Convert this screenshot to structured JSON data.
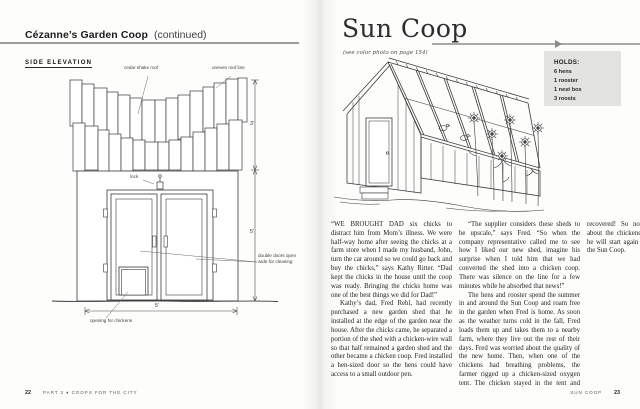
{
  "left_page": {
    "header": {
      "title": "Cézanne’s Garden Coop",
      "continued": "(continued)"
    },
    "section_label": "SIDE ELEVATION",
    "labels": {
      "cedar": "cedar shake roof",
      "uneven": "uneven roof line",
      "lock": "lock",
      "doors": "double doors open wide for cleaning",
      "opening": "opening for chickens",
      "dim_roof": "3'",
      "dim_wall": "5'",
      "dim_width": "5'"
    },
    "footer": {
      "page_number": "22",
      "text": "PART 2 ♦ COOPS FOR THE CITY"
    }
  },
  "right_page": {
    "title": "Sun Coop",
    "subtitle": "(see color photo on page 154)",
    "holds_box": {
      "heading": "HOLDS:",
      "items": [
        "6 hens",
        "1 rooster",
        "1 nest box",
        "3 roosts"
      ]
    },
    "body": {
      "paragraphs": [
        "“WE BROUGHT DAD six chicks to distract him from Mom’s illness. We were half-way home after seeing the chicks at a farm store when I made my husband, John, turn the car around so we could go back and buy the chicks,” says Kathy Ritter. “Dad kept the chicks in the house until the coop was ready. Bringing the chicks home was one of the best things we did for Dad!”",
        "Kathy’s dad, Fred Rehl, had recently purchased a new garden shed that he installed at the edge of the garden near the house. After the chicks came, he separated a portion of the shed with a chicken-wire wall so that half remained a garden shed and the other became a chicken coop. Fred installed a hen-sized door so the hens could have access to a small outdoor pen.",
        "“The supplier considers these sheds to be upscale,” says Fred. “So when the company representative called me to see how I liked our new shed, imagine his surprise when I told him that we had converted the shed into a chicken coop. There was silence on the line for a few minutes while he absorbed that news!”",
        "The hens and rooster spend the summer in and around the Sun Coop and roam free in the garden when Fred is home. As soon as the weather turns cold in the fall, Fred loads them up and takes them to a nearby farm, where they live out the rest of their days. Fred was worried about the quality of the new home. Then, when one of the chickens had breathing problems, the farmer rigged up a chicken-sized oxygen tent. The chicken stayed in the tent and recovered! So now Fred doesn’t worry about the chickens anymore. Next spring, he will start again with six new chicks for the Sun Coop."
      ]
    },
    "footer": {
      "label": "SUN COOP",
      "page_number": "23"
    }
  },
  "colors": {
    "header_rule": "#9c9c9c",
    "title_rule": "#a9a9a7",
    "holds_bg": "#e3e3e0",
    "ink": "#3a3a3a",
    "body_text": "#1c1c1c"
  }
}
